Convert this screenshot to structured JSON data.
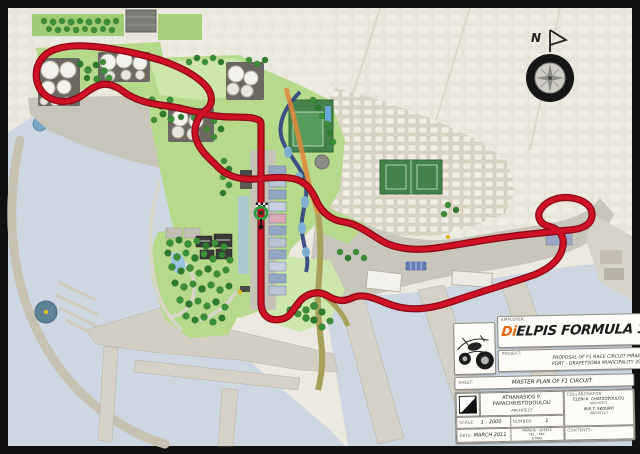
{
  "title_block": {
    "employer_label": "EMPLOYER:",
    "logo": {
      "di": "Di",
      "rest": "ELPIS",
      "series": " FORMULA 1"
    },
    "project_label": "PROJECT:",
    "project_line1": "PROPOSAL OF F1 RACE CIRCUIT PIRAEUS",
    "project_line2": "PORT - DRAPETSONA MUNICIPALITY 2011",
    "sheet_label": "SHEET:",
    "sheet_title": "MASTER PLAN OF F1 CIRCUIT",
    "architect": {
      "name": "ATHANASIOS P. PAPACHRISTODOULOU",
      "title": "ARCHITECT"
    },
    "collaborator_label": "COLLABORATOR:",
    "collaborators": [
      {
        "name": "ELENI K. CHATZOPOULOU",
        "title": "ARCHITECT"
      },
      {
        "name": "IRIS T. SKOURTI",
        "title": "ARCHITECT"
      }
    ],
    "contents_label": "CONTENTS:",
    "scale_label": "SCALE:",
    "scale_value": "1 : 2000",
    "number_label": "NUMBER:",
    "number_value": "1",
    "date_label": "DATE:",
    "date_value": "MARCH 2011",
    "contact_lines": [
      "PIRAEUS - GREECE",
      "TEL. / FAX.",
      "E-MAIL"
    ]
  },
  "compass": {
    "north_label": "N"
  },
  "colors": {
    "track_red": "#cf1126",
    "track_edge": "#8c0a16",
    "park_green": "#b7d98b",
    "tree_green": "#3c8f38",
    "water_blue": "#ccd7e1",
    "canal_blue": "#2e3f7e",
    "road_orange": "#e0873c",
    "logo_orange": "#e8650e",
    "paper": "#ece9e1",
    "frame_black": "#111111"
  }
}
